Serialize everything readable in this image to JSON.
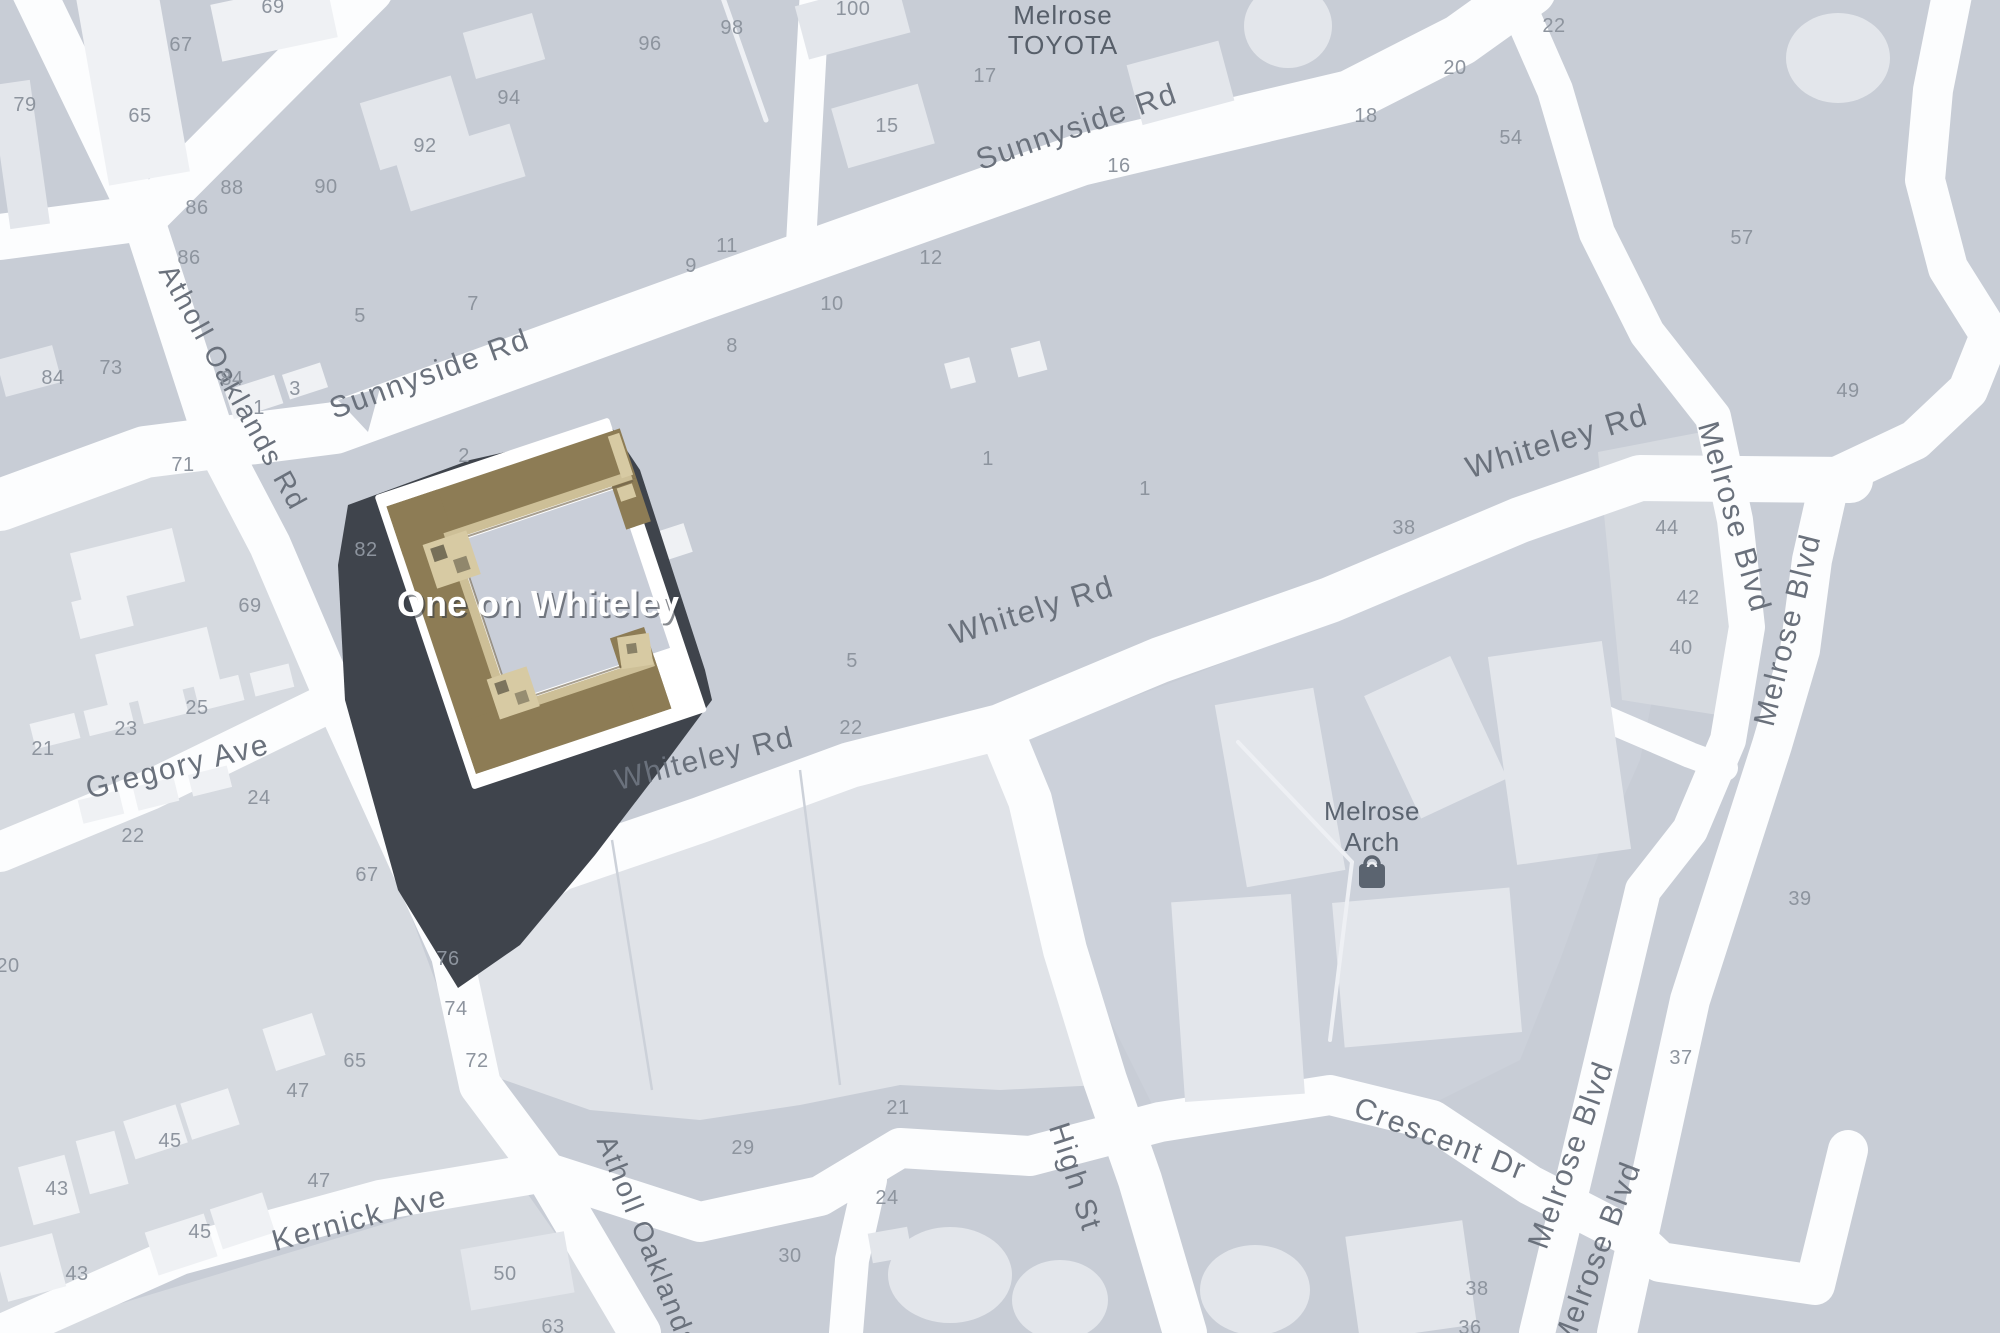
{
  "map": {
    "building_label": "One on Whiteley",
    "dealer": {
      "line1": "Melrose",
      "line2": "TOYOTA"
    },
    "poi": {
      "line1": "Melrose",
      "line2": "Arch",
      "icon": "shopping-bag-icon"
    },
    "colors": {
      "base": "#c8cdd6",
      "road": "#fcfdfe",
      "parcel_light": "#d6dae0",
      "building_light": "#e3e6eb",
      "building_white": "#eff1f4",
      "highlight_roof_tan": "#8d7c55",
      "highlight_roof_light": "#cdbf97",
      "highlight_plate": "#ffffff",
      "highlight_shadow": "#3f444c",
      "street_label": "#6a717c",
      "house_number": "#8d949e",
      "poi": "#5b6470"
    },
    "street_labels": [
      {
        "text": "Sunnyside Rd",
        "x": 433,
        "y": 383,
        "rot": -20,
        "size": 30
      },
      {
        "text": "Sunnyside Rd",
        "x": 1080,
        "y": 136,
        "rot": -19,
        "size": 30
      },
      {
        "text": "Atholl Oaklands Rd",
        "x": 225,
        "y": 392,
        "rot": 61,
        "size": 28
      },
      {
        "text": "Atholl Oaklands Rd",
        "x": 648,
        "y": 1268,
        "rot": 68,
        "size": 28
      },
      {
        "text": "Gregory Ave",
        "x": 180,
        "y": 776,
        "rot": -14,
        "size": 30
      },
      {
        "text": "Kernick Ave",
        "x": 362,
        "y": 1228,
        "rot": -15,
        "size": 30
      },
      {
        "text": "Whiteley Rd",
        "x": 707,
        "y": 768,
        "rot": -14,
        "size": 30
      },
      {
        "text": "Whitely Rd",
        "x": 1035,
        "y": 620,
        "rot": -17,
        "size": 31
      },
      {
        "text": "Whiteley Rd",
        "x": 1560,
        "y": 451,
        "rot": -17,
        "size": 31
      },
      {
        "text": "High St",
        "x": 1066,
        "y": 1180,
        "rot": 72,
        "size": 30
      },
      {
        "text": "Crescent Dr",
        "x": 1437,
        "y": 1148,
        "rot": 21,
        "size": 30
      },
      {
        "text": "Melrose Blvd",
        "x": 1725,
        "y": 520,
        "rot": 74,
        "size": 30
      },
      {
        "text": "Melrose Blvd",
        "x": 1797,
        "y": 632,
        "rot": -76,
        "size": 30
      },
      {
        "text": "Melrose Blvd",
        "x": 1580,
        "y": 1158,
        "rot": -70,
        "size": 30
      },
      {
        "text": "Melrose Blvd",
        "x": 1606,
        "y": 1258,
        "rot": -69,
        "size": 30
      }
    ],
    "house_numbers": [
      {
        "text": "69",
        "x": 273,
        "y": 13
      },
      {
        "text": "67",
        "x": 181,
        "y": 51
      },
      {
        "text": "79",
        "x": 25,
        "y": 111
      },
      {
        "text": "65",
        "x": 140,
        "y": 122
      },
      {
        "text": "96",
        "x": 650,
        "y": 50
      },
      {
        "text": "94",
        "x": 509,
        "y": 104
      },
      {
        "text": "98",
        "x": 732,
        "y": 34
      },
      {
        "text": "100",
        "x": 853,
        "y": 15
      },
      {
        "text": "92",
        "x": 425,
        "y": 152
      },
      {
        "text": "90",
        "x": 326,
        "y": 193
      },
      {
        "text": "88",
        "x": 232,
        "y": 194
      },
      {
        "text": "86",
        "x": 197,
        "y": 214
      },
      {
        "text": "86",
        "x": 189,
        "y": 264
      },
      {
        "text": "5",
        "x": 360,
        "y": 322
      },
      {
        "text": "7",
        "x": 473,
        "y": 310
      },
      {
        "text": "84",
        "x": 53,
        "y": 384
      },
      {
        "text": "73",
        "x": 111,
        "y": 374
      },
      {
        "text": "84",
        "x": 232,
        "y": 385
      },
      {
        "text": "1",
        "x": 259,
        "y": 414
      },
      {
        "text": "3",
        "x": 295,
        "y": 395
      },
      {
        "text": "9",
        "x": 691,
        "y": 272
      },
      {
        "text": "11",
        "x": 727,
        "y": 252
      },
      {
        "text": "8",
        "x": 732,
        "y": 352
      },
      {
        "text": "10",
        "x": 832,
        "y": 310
      },
      {
        "text": "12",
        "x": 931,
        "y": 264
      },
      {
        "text": "15",
        "x": 887,
        "y": 132
      },
      {
        "text": "17",
        "x": 985,
        "y": 82
      },
      {
        "text": "16",
        "x": 1119,
        "y": 172
      },
      {
        "text": "18",
        "x": 1366,
        "y": 122
      },
      {
        "text": "20",
        "x": 1455,
        "y": 74
      },
      {
        "text": "22",
        "x": 1554,
        "y": 32
      },
      {
        "text": "54",
        "x": 1511,
        "y": 144
      },
      {
        "text": "57",
        "x": 1742,
        "y": 244
      },
      {
        "text": "49",
        "x": 1848,
        "y": 397
      },
      {
        "text": "2",
        "x": 464,
        "y": 462
      },
      {
        "text": "82",
        "x": 366,
        "y": 556
      },
      {
        "text": "71",
        "x": 183,
        "y": 471
      },
      {
        "text": "69",
        "x": 250,
        "y": 612
      },
      {
        "text": "25",
        "x": 197,
        "y": 714
      },
      {
        "text": "23",
        "x": 126,
        "y": 735
      },
      {
        "text": "21",
        "x": 43,
        "y": 755
      },
      {
        "text": "24",
        "x": 259,
        "y": 804
      },
      {
        "text": "22",
        "x": 133,
        "y": 842
      },
      {
        "text": "67",
        "x": 367,
        "y": 881
      },
      {
        "text": "1",
        "x": 988,
        "y": 465
      },
      {
        "text": "1",
        "x": 1145,
        "y": 495
      },
      {
        "text": "38",
        "x": 1404,
        "y": 534
      },
      {
        "text": "44",
        "x": 1667,
        "y": 534
      },
      {
        "text": "42",
        "x": 1688,
        "y": 604
      },
      {
        "text": "40",
        "x": 1681,
        "y": 654
      },
      {
        "text": "5",
        "x": 852,
        "y": 667
      },
      {
        "text": "22",
        "x": 851,
        "y": 734
      },
      {
        "text": "39",
        "x": 1800,
        "y": 905
      },
      {
        "text": "37",
        "x": 1681,
        "y": 1064
      },
      {
        "text": "20",
        "x": 8,
        "y": 972
      },
      {
        "text": "76",
        "x": 448,
        "y": 965
      },
      {
        "text": "74",
        "x": 456,
        "y": 1015
      },
      {
        "text": "72",
        "x": 477,
        "y": 1067
      },
      {
        "text": "65",
        "x": 355,
        "y": 1067
      },
      {
        "text": "47",
        "x": 298,
        "y": 1097
      },
      {
        "text": "45",
        "x": 170,
        "y": 1147
      },
      {
        "text": "43",
        "x": 57,
        "y": 1195
      },
      {
        "text": "47",
        "x": 319,
        "y": 1187
      },
      {
        "text": "45",
        "x": 200,
        "y": 1238
      },
      {
        "text": "43",
        "x": 77,
        "y": 1280
      },
      {
        "text": "50",
        "x": 505,
        "y": 1280
      },
      {
        "text": "63",
        "x": 553,
        "y": 1333
      },
      {
        "text": "29",
        "x": 743,
        "y": 1154
      },
      {
        "text": "21",
        "x": 898,
        "y": 1114
      },
      {
        "text": "24",
        "x": 887,
        "y": 1204
      },
      {
        "text": "30",
        "x": 790,
        "y": 1262
      },
      {
        "text": "38",
        "x": 1477,
        "y": 1295
      },
      {
        "text": "36",
        "x": 1470,
        "y": 1334
      }
    ]
  }
}
